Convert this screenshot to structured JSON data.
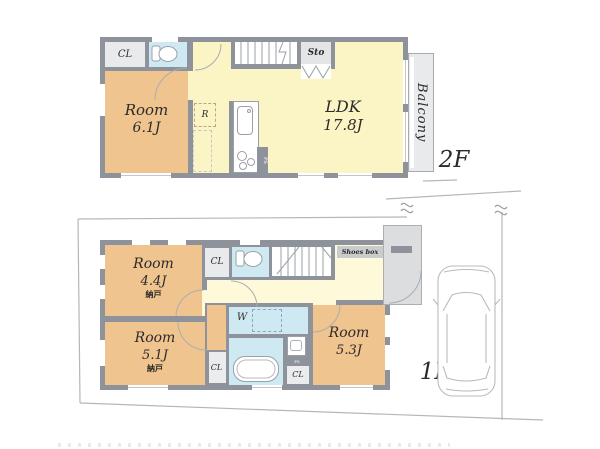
{
  "floor2": {
    "label": "2F",
    "cl": "CL",
    "sto": "Sto",
    "room_name": "Room",
    "room_size": "6.1J",
    "ldk_name": "LDK",
    "ldk_size": "17.8J",
    "balcony": "Balcony",
    "fridge": "R",
    "ps": "PS"
  },
  "floor1": {
    "label": "1F",
    "room44_name": "Room",
    "room44_size": "4.4J",
    "room44_note": "納戸",
    "room51_name": "Room",
    "room51_size": "5.1J",
    "room51_note": "納戸",
    "room53_name": "Room",
    "room53_size": "5.3J",
    "cl_hall": "CL",
    "cl_side": "CL",
    "cl_bath": "CL",
    "shoes_box": "Shoes box",
    "washer": "W",
    "ps": "PS"
  },
  "colors": {
    "wall": "#8e939b",
    "room_orange": "#f0c48e",
    "ldk_yellow": "#fbf4c4",
    "hall_yellow": "#fdf9d9",
    "wet_blue": "#cfe9f2",
    "closet_gray": "#e9eaeb",
    "porch_gray": "#dcddde"
  }
}
